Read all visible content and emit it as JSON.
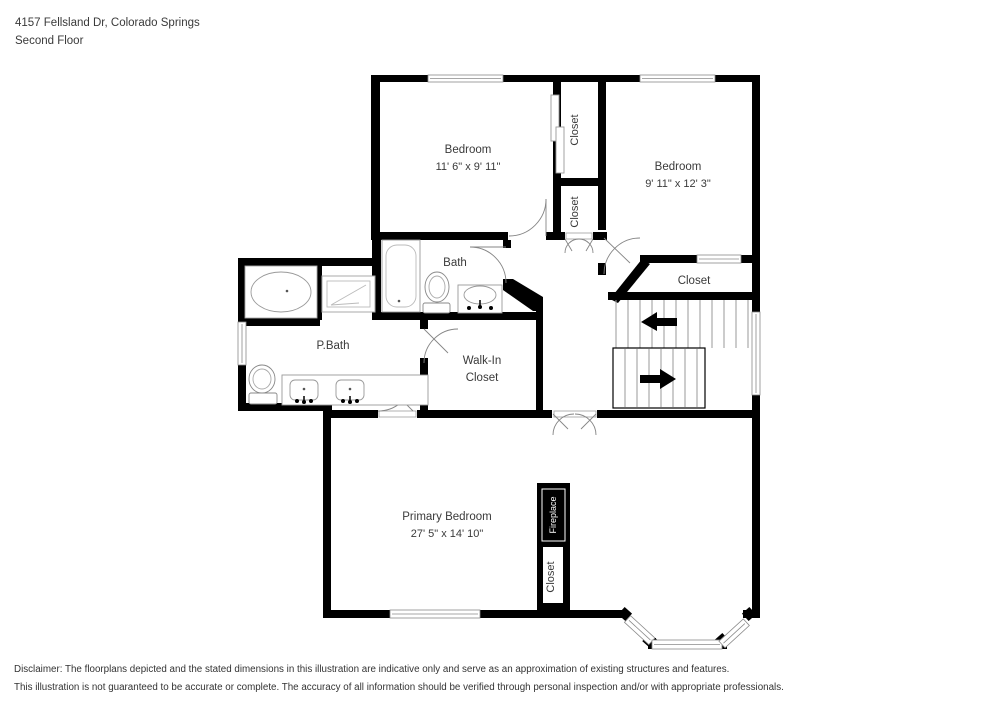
{
  "header": {
    "address": "4157 Fellsland Dr, Colorado Springs",
    "floor_label": "Second Floor"
  },
  "rooms": {
    "bedroom_top_left": {
      "label": "Bedroom",
      "dimensions": "11' 6\" x 9' 11\""
    },
    "bedroom_top_right": {
      "label": "Bedroom",
      "dimensions": "9' 11\" x 12' 3\""
    },
    "bath": {
      "label": "Bath"
    },
    "primary_bath": {
      "label": "P.Bath"
    },
    "walk_in_closet": {
      "label_line1": "Walk-In",
      "label_line2": "Closet"
    },
    "hall_closet": {
      "label": "Closet"
    },
    "bedroom_closet_upper": {
      "label": "Closet"
    },
    "bedroom_closet_lower": {
      "label": "Closet"
    },
    "primary_bedroom": {
      "label": "Primary Bedroom",
      "dimensions": "27' 5\" x 14' 10\""
    },
    "fireplace": {
      "label": "Fireplace"
    },
    "primary_closet": {
      "label": "Closet"
    }
  },
  "disclaimer": {
    "line1": "Disclaimer: The floorplans depicted and the stated dimensions in this illustration are indicative only and serve as an approximation of existing structures and features.",
    "line2": "This illustration is not guaranteed to be accurate or complete. The accuracy of all information should be verified through personal inspection and/or with appropriate professionals."
  },
  "colors": {
    "wall": "#000000",
    "text": "#3a3a3a",
    "fixture_outline": "#999999",
    "window_frame": "#8a8a8a"
  }
}
